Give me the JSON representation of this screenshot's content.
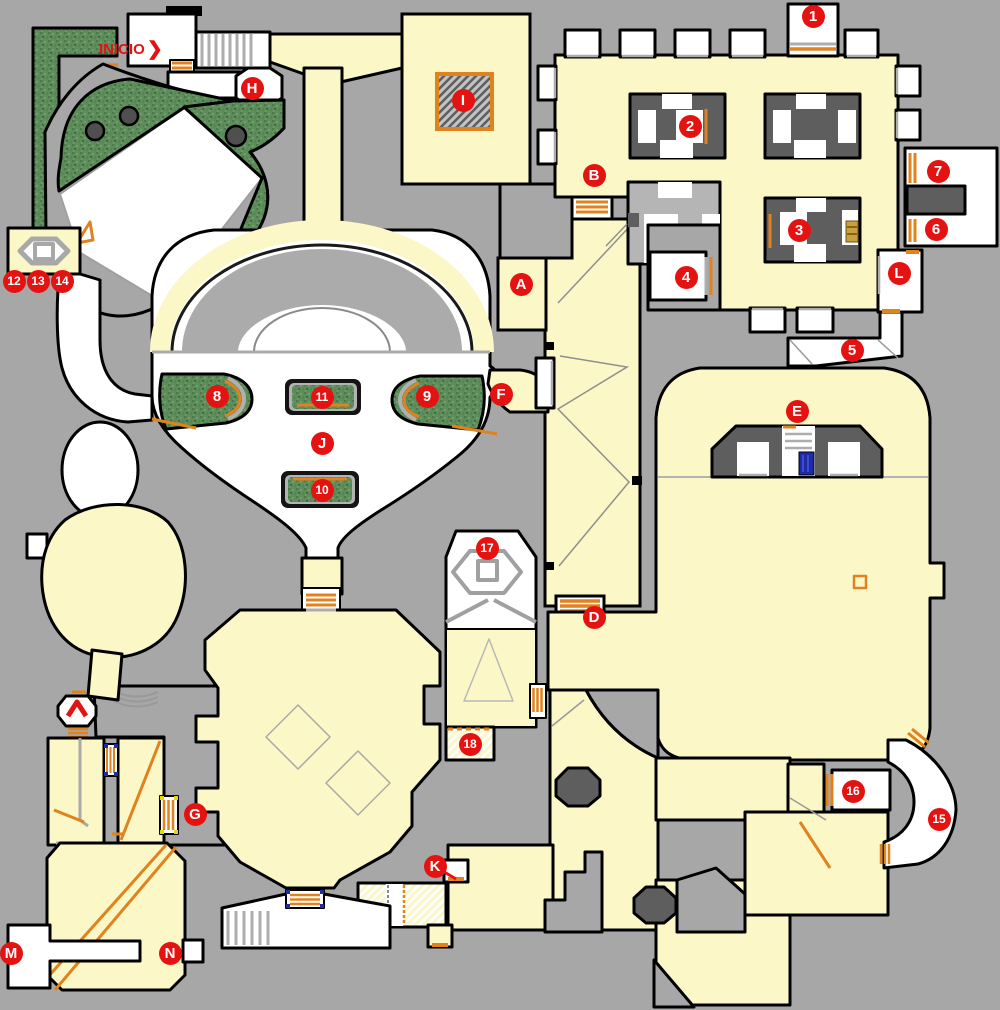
{
  "palette": {
    "background": "#A7A7A7",
    "floor": "#FBF7C6",
    "room_white": "#FFFFFF",
    "wall": "#000000",
    "structure_dark": "#5E5E5E",
    "structure_light": "#B5B5B5",
    "grass_green": "#5E8C5C",
    "door_orange": "#E0821E",
    "marker_red": "#E51212",
    "marker_text": "#FFFFFF",
    "key_blue": "#1C2CA8",
    "key_yellow": "#E8D800",
    "sill_silver": "#ADADAD"
  },
  "start_label": {
    "text": "INICIO",
    "arrow": "❯"
  },
  "markers": [
    {
      "label": "1",
      "x": 813,
      "y": 16
    },
    {
      "label": "2",
      "x": 690,
      "y": 126
    },
    {
      "label": "3",
      "x": 799,
      "y": 230
    },
    {
      "label": "4",
      "x": 686,
      "y": 277
    },
    {
      "label": "5",
      "x": 852,
      "y": 350
    },
    {
      "label": "6",
      "x": 936,
      "y": 229
    },
    {
      "label": "7",
      "x": 938,
      "y": 171
    },
    {
      "label": "8",
      "x": 217,
      "y": 396
    },
    {
      "label": "9",
      "x": 427,
      "y": 396
    },
    {
      "label": "10",
      "x": 322,
      "y": 490
    },
    {
      "label": "11",
      "x": 322,
      "y": 397
    },
    {
      "label": "12",
      "x": 14,
      "y": 281
    },
    {
      "label": "13",
      "x": 38,
      "y": 281
    },
    {
      "label": "14",
      "x": 62,
      "y": 281
    },
    {
      "label": "15",
      "x": 939,
      "y": 819
    },
    {
      "label": "16",
      "x": 853,
      "y": 791
    },
    {
      "label": "17",
      "x": 487,
      "y": 548
    },
    {
      "label": "18",
      "x": 470,
      "y": 744
    },
    {
      "label": "A",
      "x": 521,
      "y": 284
    },
    {
      "label": "B",
      "x": 594,
      "y": 175
    },
    {
      "label": "D",
      "x": 594,
      "y": 617
    },
    {
      "label": "E",
      "x": 797,
      "y": 411
    },
    {
      "label": "F",
      "x": 501,
      "y": 394
    },
    {
      "label": "G",
      "x": 195,
      "y": 814
    },
    {
      "label": "H",
      "x": 252,
      "y": 88
    },
    {
      "label": "I",
      "x": 463,
      "y": 100
    },
    {
      "label": "J",
      "x": 322,
      "y": 443
    },
    {
      "label": "K",
      "x": 435,
      "y": 866
    },
    {
      "label": "L",
      "x": 899,
      "y": 273
    },
    {
      "label": "M",
      "x": 11,
      "y": 953
    },
    {
      "label": "N",
      "x": 170,
      "y": 953
    }
  ],
  "map_features": [
    {
      "name": "start-arrow"
    },
    {
      "name": "teleporter-pad"
    },
    {
      "name": "item-pedestal"
    },
    {
      "name": "blue-item"
    },
    {
      "name": "exit-chevron"
    },
    {
      "name": "secret-hatched-floor"
    }
  ]
}
